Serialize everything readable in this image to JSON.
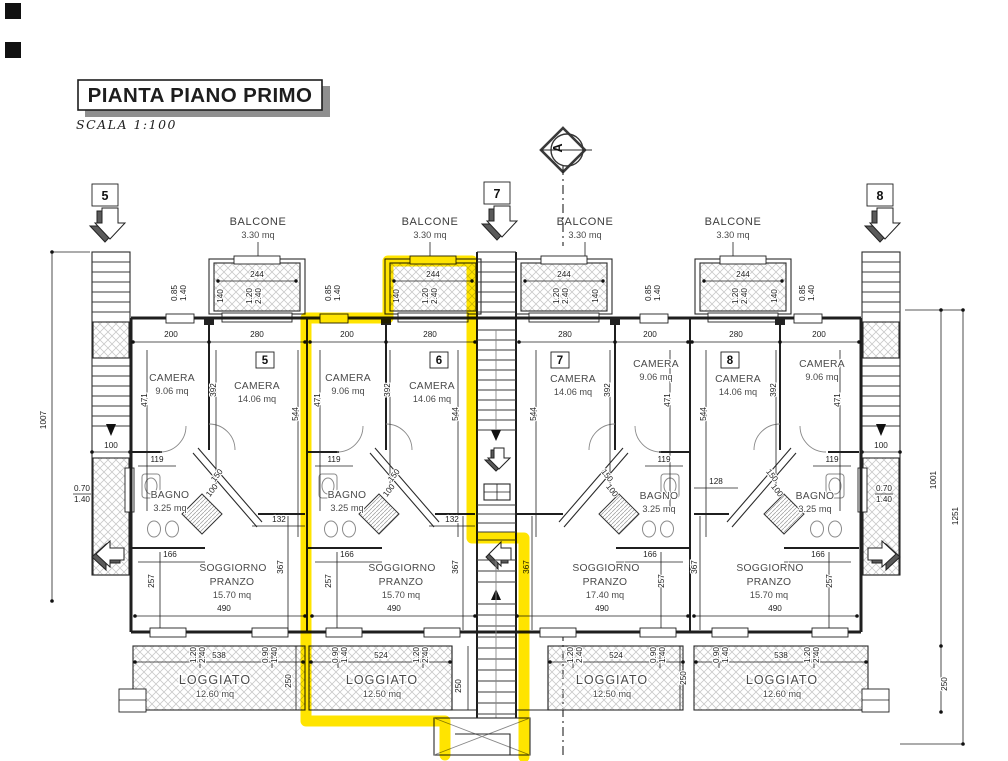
{
  "page": {
    "title": "PIANTA PIANO PRIMO",
    "scale": "SCALA  1:100",
    "section": "A"
  },
  "markers": [
    "5",
    "7",
    "8"
  ],
  "balcony": {
    "label": "BALCONE",
    "area": "3.30 mq",
    "w": "244",
    "d": "140"
  },
  "shared": {
    "w_small": "200",
    "w_large": "280",
    "h_small": "471",
    "h_mid": "392",
    "h_large": "544",
    "bagno_w": "119",
    "diag_a": "150",
    "diag_b": "100",
    "bagno_b": "166",
    "sogg_a": "257",
    "sogg_b": "367",
    "sogg_w": "490",
    "logg_h": "250",
    "win_120": "1.20",
    "win_240": "2.40",
    "win_090": "0.90",
    "win_140": "1.40",
    "win_085": "0.85"
  },
  "units": [
    {
      "id": "5",
      "camera_small_label": "CAMERA",
      "camera_small_area": "9.06 mq",
      "camera_large_label": "CAMERA",
      "camera_large_area": "14.06 mq",
      "bagno_label": "BAGNO",
      "bagno_area": "3.25 mq",
      "sogg_label1": "SOGGIORNO",
      "sogg_label2": "PRANZO",
      "sogg_area": "15.70 mq",
      "ledge": "132",
      "logg_label": "LOGGIATO",
      "logg_area": "12.60 mq",
      "logg_w": "538"
    },
    {
      "id": "6",
      "camera_small_label": "CAMERA",
      "camera_small_area": "9.06 mq",
      "camera_large_label": "CAMERA",
      "camera_large_area": "14.06 mq",
      "bagno_label": "BAGNO",
      "bagno_area": "3.25 mq",
      "sogg_label1": "SOGGIORNO",
      "sogg_label2": "PRANZO",
      "sogg_area": "15.70 mq",
      "ledge": "132",
      "logg_label": "LOGGIATO",
      "logg_area": "12.50 mq",
      "logg_w": "524"
    },
    {
      "id": "7",
      "camera_small_label": "CAMERA",
      "camera_small_area": "9.06 mq",
      "camera_large_label": "CAMERA",
      "camera_large_area": "14.06 mq",
      "bagno_label": "BAGNO",
      "bagno_area": "3.25 mq",
      "sogg_label1": "SOGGIORNO",
      "sogg_label2": "PRANZO",
      "sogg_area": "17.40 mq",
      "logg_label": "LOGGIATO",
      "logg_area": "12.50 mq",
      "logg_w": "524"
    },
    {
      "id": "8",
      "camera_small_label": "CAMERA",
      "camera_small_area": "9.06 mq",
      "camera_large_label": "CAMERA",
      "camera_large_area": "14.06 mq",
      "bagno_label": "BAGNO",
      "bagno_area": "3.25 mq",
      "sogg_label1": "SOGGIORNO",
      "sogg_label2": "PRANZO",
      "sogg_area": "15.70 mq",
      "ledge": "128",
      "logg_label": "LOGGIATO",
      "logg_area": "12.60 mq",
      "logg_w": "538"
    }
  ],
  "site": {
    "left_h": "1007",
    "stair_w": "100",
    "win_a": "0.70",
    "win_b": "1.40",
    "right_inner": "1001",
    "right_outer": "1251"
  }
}
